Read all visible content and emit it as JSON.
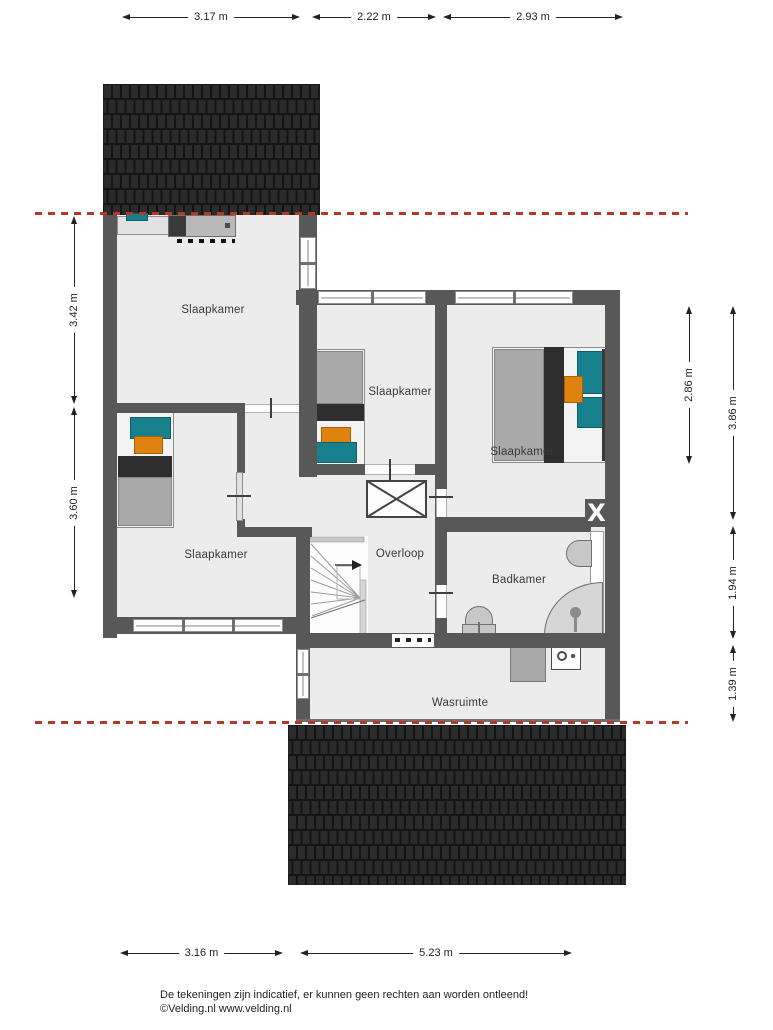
{
  "floorplan": {
    "rooms": [
      {
        "name": "slaapkamer-topleft",
        "label": "Slaapkamer"
      },
      {
        "name": "slaapkamer-middle",
        "label": "Slaapkamer"
      },
      {
        "name": "slaapkamer-right",
        "label": "Slaapkamer"
      },
      {
        "name": "slaapkamer-bottomleft",
        "label": "Slaapkamer"
      },
      {
        "name": "overloop",
        "label": "Overloop"
      },
      {
        "name": "badkamer",
        "label": "Badkamer"
      },
      {
        "name": "wasruimte",
        "label": "Wasruimte"
      }
    ],
    "dimensions": {
      "top": [
        {
          "label": "3.17 m"
        },
        {
          "label": "2.22 m"
        },
        {
          "label": "2.93 m"
        }
      ],
      "left": [
        {
          "label": "3.42 m"
        },
        {
          "label": "3.60 m"
        }
      ],
      "right": [
        {
          "label": "2.86 m"
        },
        {
          "label": "3.86 m"
        },
        {
          "label": "1.94 m"
        },
        {
          "label": "1.39 m"
        }
      ],
      "bottom": [
        {
          "label": "3.16 m"
        },
        {
          "label": "5.23 m"
        }
      ]
    },
    "symbols": {
      "flue": "X"
    },
    "colors": {
      "wall": "#585858",
      "floor": "#ececec",
      "roof_tile": "#2b2b2b",
      "section_line": "#b23a2d",
      "accent_teal": "#17808c",
      "accent_orange": "#e0820f"
    }
  },
  "footer": {
    "line1": "De tekeningen zijn indicatief, er kunnen geen rechten aan worden ontleend!",
    "line2": "©Velding.nl www.velding.nl"
  }
}
